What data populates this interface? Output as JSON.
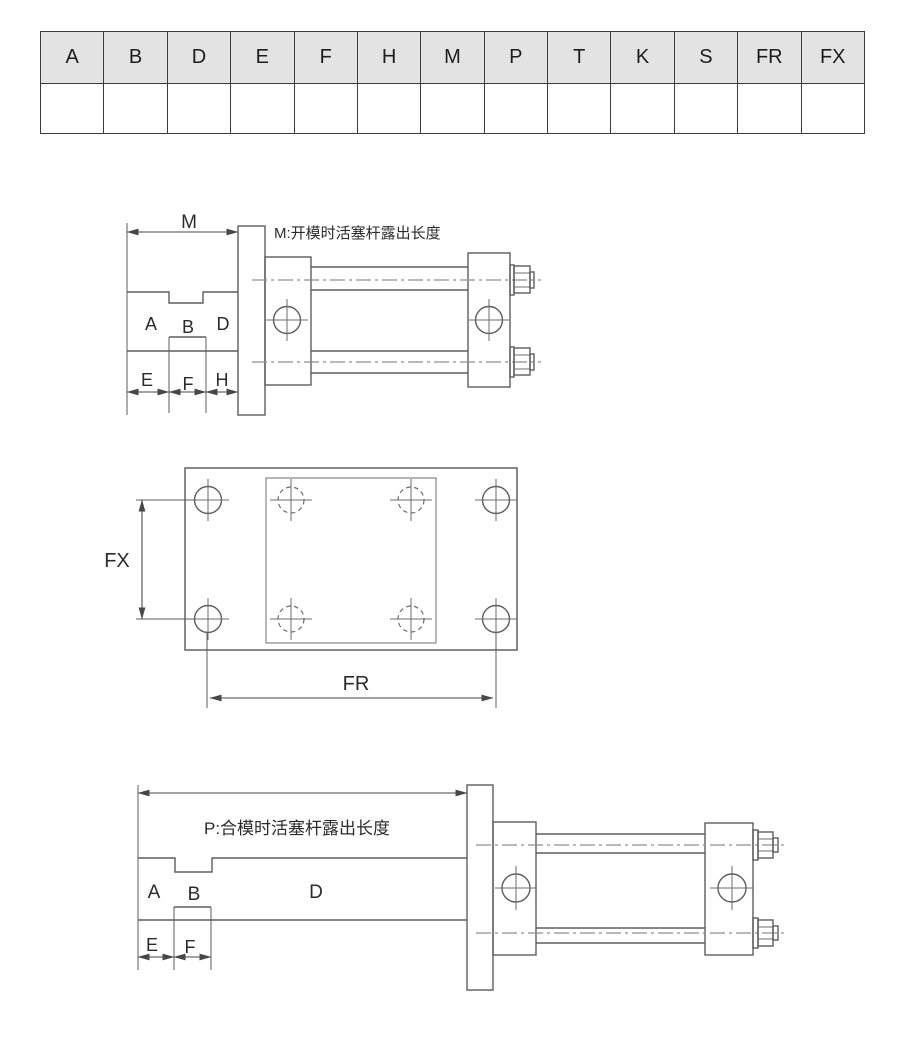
{
  "colors": {
    "background": "#ffffff",
    "table_header_bg": "#e3e3e3",
    "table_border": "#3c3c3c",
    "line": "#5d5d5d",
    "centerline": "#8f8f8f",
    "text": "#2b2b2b"
  },
  "table": {
    "columns": [
      "A",
      "B",
      "D",
      "E",
      "F",
      "H",
      "M",
      "P",
      "T",
      "K",
      "S",
      "FR",
      "FX"
    ]
  },
  "views": {
    "open": {
      "note": "M:开模时活塞杆露出长度",
      "labels": {
        "m": "M",
        "a": "A",
        "b": "B",
        "d": "D",
        "e": "E",
        "f": "F",
        "h": "H"
      }
    },
    "flange": {
      "labels": {
        "fx": "FX",
        "fr": "FR"
      }
    },
    "closed": {
      "note": "P:合模时活塞杆露出长度",
      "labels": {
        "a": "A",
        "b": "B",
        "d": "D",
        "e": "E",
        "f": "F"
      }
    }
  }
}
